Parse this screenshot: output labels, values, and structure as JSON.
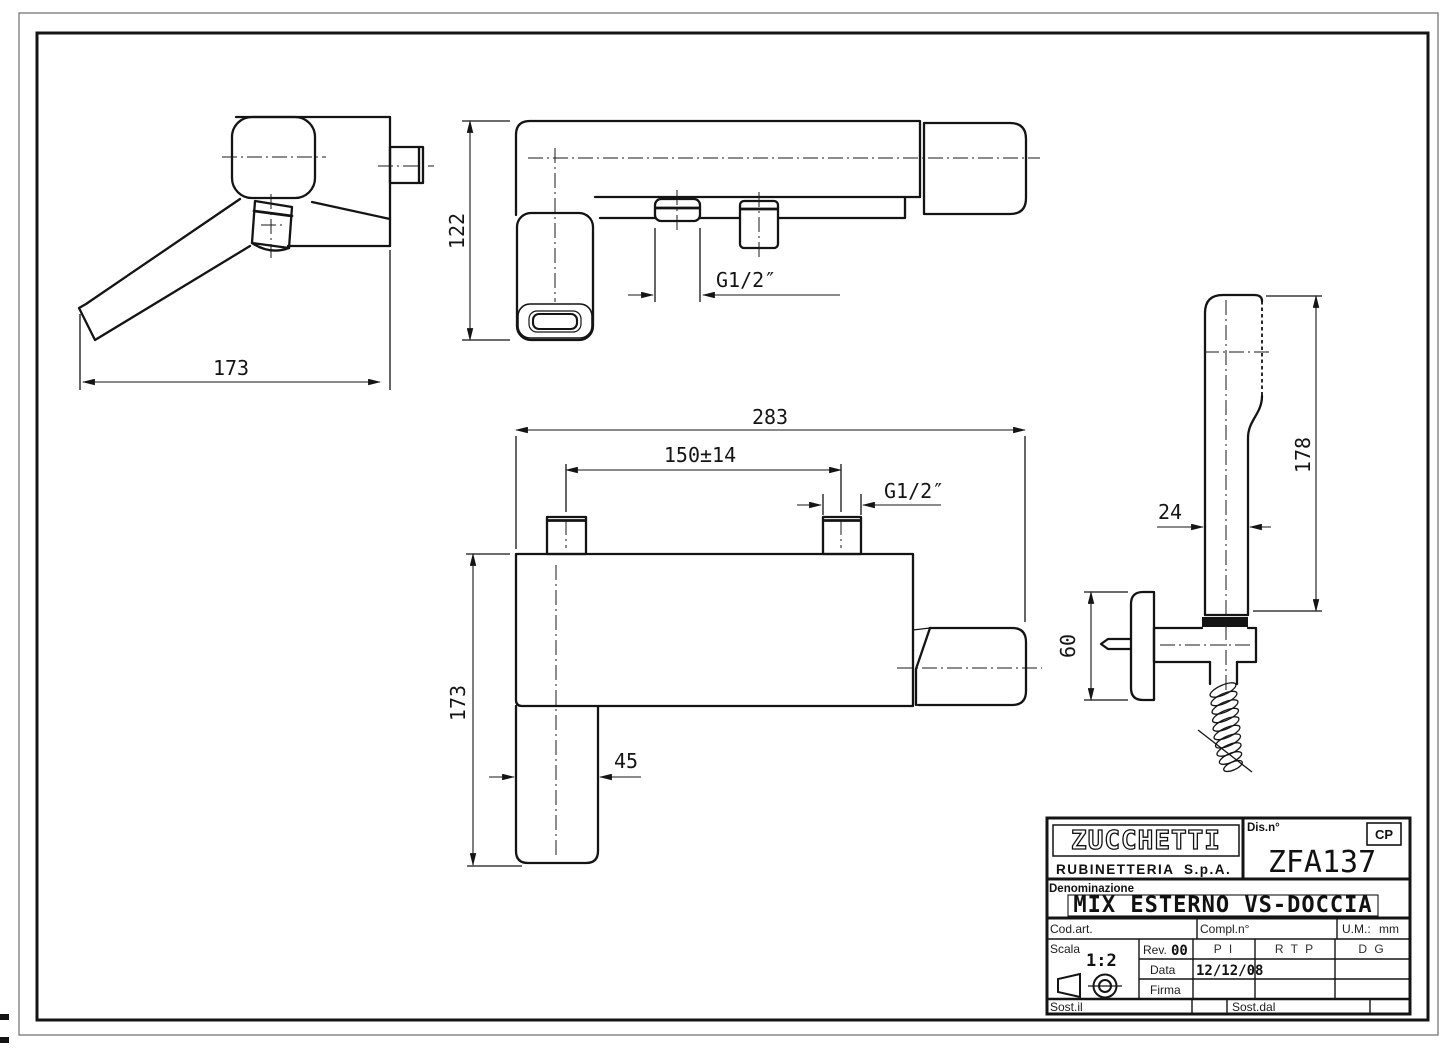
{
  "sheet": {
    "background": "#ffffff",
    "line_color": "#141414",
    "frame_color": "#808080"
  },
  "dimensions": {
    "side_length": "173",
    "top_height": "122",
    "top_thread": "G1/2″",
    "front_width": "283",
    "front_interaxis": "150±14",
    "front_thread": "G1/2″",
    "front_height": "173",
    "front_spout_width": "45",
    "shower_length": "178",
    "shower_width": "24",
    "shower_bracket_height": "60"
  },
  "title_block": {
    "logo_text": "ZUCCHETTI",
    "logo_line1": "RUBINETTERIA",
    "logo_line2": "S.p.A.",
    "drawing_no_label": "Dis.n°",
    "drawing_no": "ZFA137",
    "cp_badge": "CP",
    "denomination_label": "Denominazione",
    "denomination": "MIX ESTERNO VS-DOCCIA",
    "cod_art_label": "Cod.art.",
    "compl_label": "Compl.n°",
    "um_label": "U.M.:",
    "um_value": "mm",
    "scala_label": "Scala",
    "scala_value": "1:2",
    "rev_label": "Rev.",
    "rev_value": "00",
    "col_pi": "P I",
    "col_rtp": "R T P",
    "col_dg": "D G",
    "data_label": "Data",
    "data_value": "12/12/08",
    "firma_label": "Firma",
    "sost_il_label": "Sost.il",
    "sost_dal_label": "Sost.dal"
  }
}
